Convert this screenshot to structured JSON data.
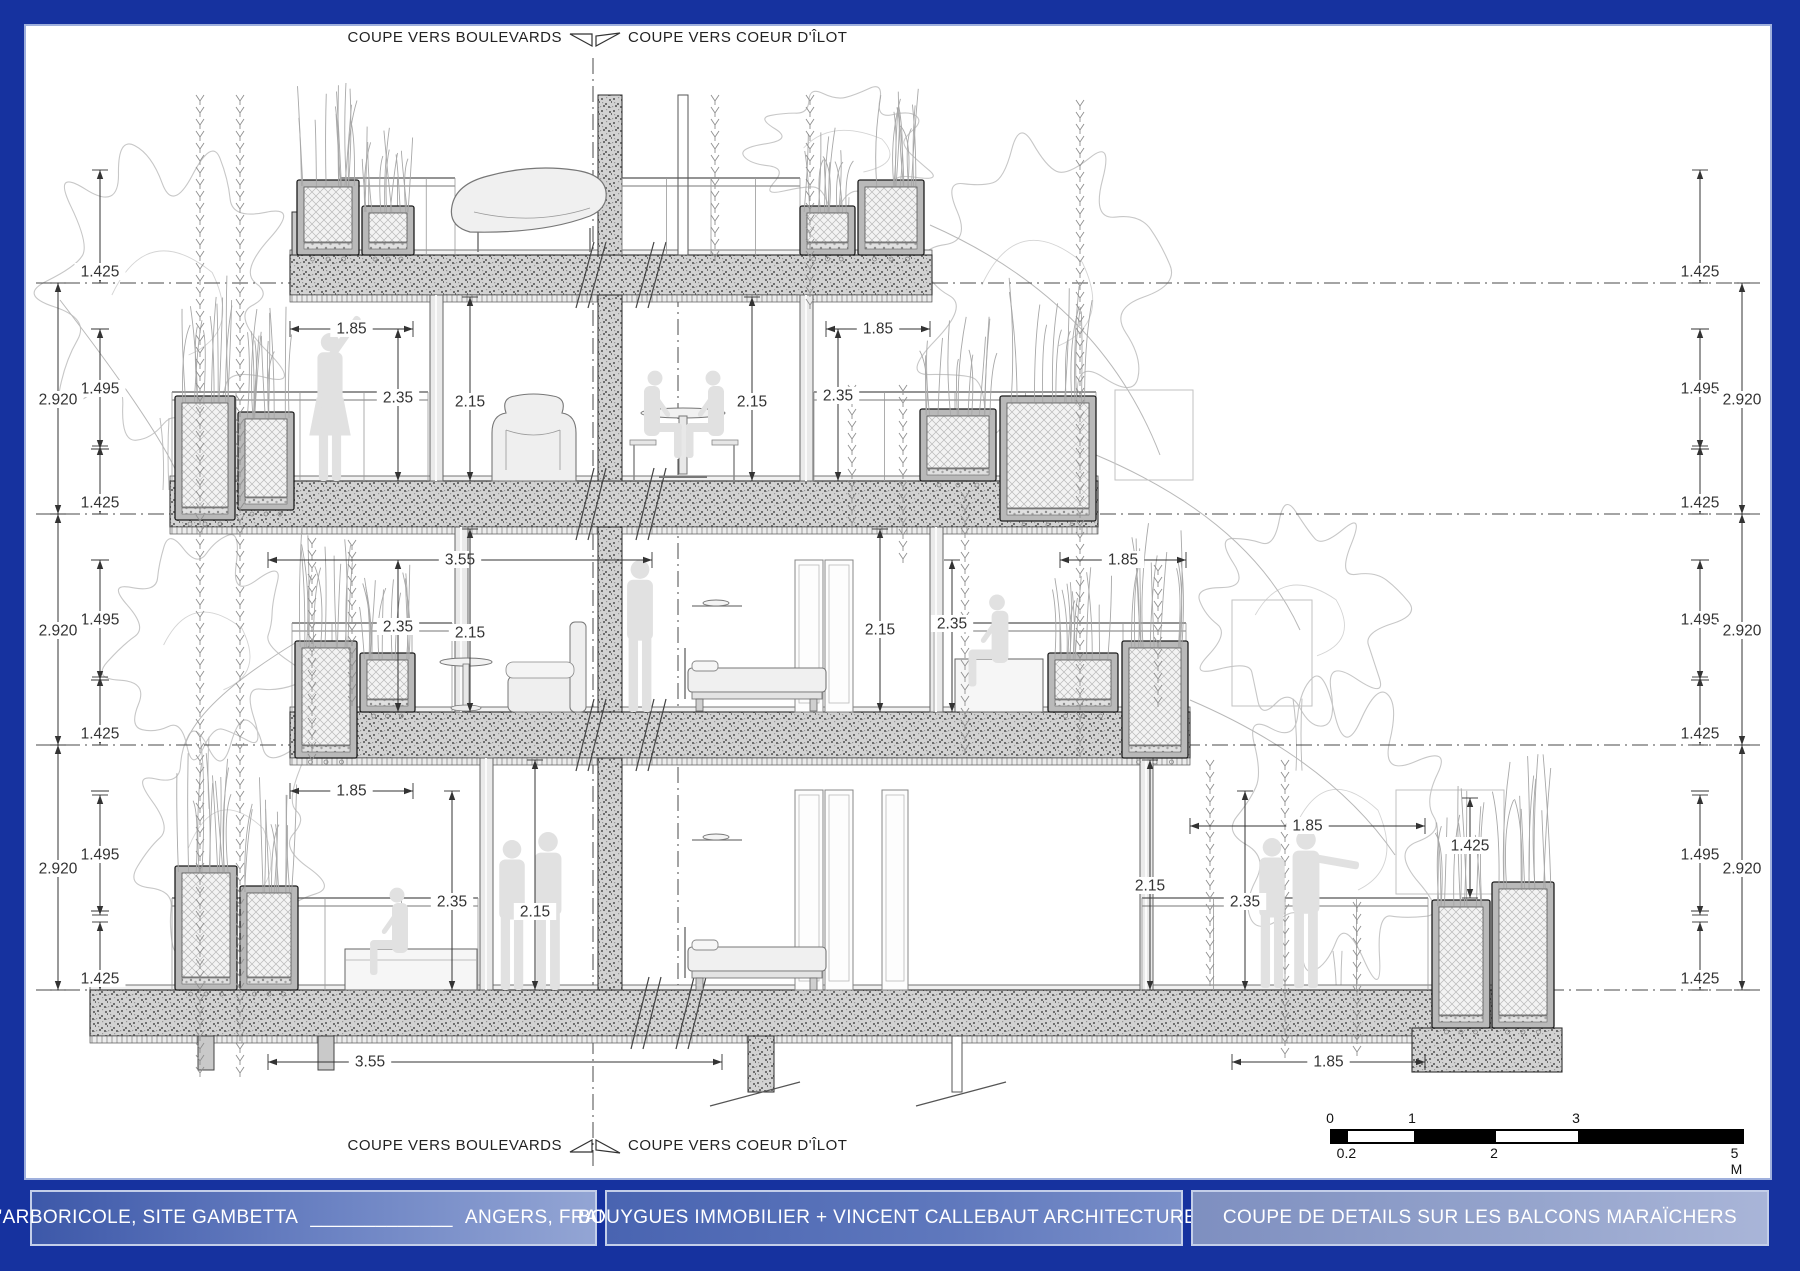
{
  "frame": {
    "border_color": "#16329f",
    "inner_line_color": "#9fb0dd",
    "paper_color": "#ffffff"
  },
  "section_markers": {
    "top_left": "COUPE VERS BOULEVARDS",
    "top_right": "COUPE VERS COEUR D'ÎLOT",
    "bottom_left": "COUPE VERS BOULEVARDS",
    "bottom_right": "COUPE VERS COEUR D'ÎLOT"
  },
  "title_bar": {
    "panel_project": {
      "name": "L'ARBORICOLE, SITE GAMBETTA",
      "separator": "_____________",
      "location": "ANGERS, FRANCE"
    },
    "panel_team": "BOUYGUES IMMOBILIER + VINCENT CALLEBAUT ARCHITECTURES",
    "panel_drawing": "COUPE DE DETAILS SUR LES BALCONS MARAÏCHERS"
  },
  "scale_bar": {
    "total_m": 5,
    "above": [
      {
        "t": "0",
        "m": 0
      },
      {
        "t": "1",
        "m": 1
      },
      {
        "t": "3",
        "m": 3
      }
    ],
    "below": [
      {
        "t": "0.2",
        "m": 0.2
      },
      {
        "t": "2",
        "m": 2
      },
      {
        "t": "5 M",
        "m": 5
      }
    ],
    "segments": [
      {
        "from": 0,
        "to": 0.2,
        "fill": "#000"
      },
      {
        "from": 0.2,
        "to": 1,
        "fill": "#fff"
      },
      {
        "from": 1,
        "to": 2,
        "fill": "#000"
      },
      {
        "from": 2,
        "to": 3,
        "fill": "#fff"
      },
      {
        "from": 3,
        "to": 5,
        "fill": "#000"
      }
    ]
  },
  "dimensions": [
    {
      "o": "v",
      "x": 100,
      "y1": 170,
      "y2": 283,
      "t": "1.425",
      "ly": 272
    },
    {
      "o": "v",
      "x": 100,
      "y1": 329,
      "y2": 449,
      "t": "1.495",
      "ly": 389
    },
    {
      "o": "v",
      "x": 58,
      "y1": 283,
      "y2": 514,
      "t": "2.920",
      "ly": 400
    },
    {
      "o": "v",
      "x": 100,
      "y1": 446,
      "y2": 514,
      "t": "1.425",
      "ly": 503
    },
    {
      "o": "v",
      "x": 100,
      "y1": 560,
      "y2": 680,
      "t": "1.495",
      "ly": 620
    },
    {
      "o": "v",
      "x": 58,
      "y1": 514,
      "y2": 745,
      "t": "2.920",
      "ly": 631
    },
    {
      "o": "v",
      "x": 100,
      "y1": 677,
      "y2": 745,
      "t": "1.425",
      "ly": 734
    },
    {
      "o": "v",
      "x": 100,
      "y1": 795,
      "y2": 915,
      "t": "1.495",
      "ly": 855
    },
    {
      "o": "v",
      "x": 58,
      "y1": 745,
      "y2": 990,
      "t": "2.920",
      "ly": 869
    },
    {
      "o": "v",
      "x": 100,
      "y1": 922,
      "y2": 990,
      "t": "1.425",
      "ly": 979
    },
    {
      "o": "v",
      "x": 1700,
      "y1": 170,
      "y2": 283,
      "t": "1.425",
      "ly": 272
    },
    {
      "o": "v",
      "x": 1700,
      "y1": 329,
      "y2": 449,
      "t": "1.495",
      "ly": 389
    },
    {
      "o": "v",
      "x": 1742,
      "y1": 283,
      "y2": 514,
      "t": "2.920",
      "ly": 400
    },
    {
      "o": "v",
      "x": 1700,
      "y1": 446,
      "y2": 514,
      "t": "1.425",
      "ly": 503
    },
    {
      "o": "v",
      "x": 1700,
      "y1": 560,
      "y2": 680,
      "t": "1.495",
      "ly": 620
    },
    {
      "o": "v",
      "x": 1742,
      "y1": 514,
      "y2": 745,
      "t": "2.920",
      "ly": 631
    },
    {
      "o": "v",
      "x": 1700,
      "y1": 677,
      "y2": 745,
      "t": "1.425",
      "ly": 734
    },
    {
      "o": "v",
      "x": 1700,
      "y1": 795,
      "y2": 915,
      "t": "1.495",
      "ly": 855
    },
    {
      "o": "v",
      "x": 1742,
      "y1": 745,
      "y2": 990,
      "t": "2.920",
      "ly": 869
    },
    {
      "o": "v",
      "x": 1700,
      "y1": 922,
      "y2": 990,
      "t": "1.425",
      "ly": 979
    },
    {
      "o": "v",
      "x": 1470,
      "y1": 798,
      "y2": 898,
      "t": "1.425",
      "ly": 846
    },
    {
      "o": "h",
      "x1": 290,
      "x2": 413,
      "y": 329,
      "t": "1.85"
    },
    {
      "o": "h",
      "x1": 826,
      "x2": 930,
      "y": 329,
      "t": "1.85"
    },
    {
      "o": "h",
      "x1": 268,
      "x2": 652,
      "y": 560,
      "t": "3.55"
    },
    {
      "o": "h",
      "x1": 1060,
      "x2": 1186,
      "y": 560,
      "t": "1.85"
    },
    {
      "o": "h",
      "x1": 290,
      "x2": 413,
      "y": 791,
      "t": "1.85"
    },
    {
      "o": "h",
      "x1": 1190,
      "x2": 1425,
      "y": 826,
      "t": "1.85"
    },
    {
      "o": "h",
      "x1": 268,
      "x2": 722,
      "y": 1062,
      "t": "3.55",
      "lx": 370
    },
    {
      "o": "h",
      "x1": 1232,
      "x2": 1425,
      "y": 1062,
      "t": "1.85"
    },
    {
      "o": "v",
      "x": 398,
      "y1": 329,
      "y2": 481,
      "t": "2.35",
      "ly": 398
    },
    {
      "o": "v",
      "x": 470,
      "y1": 297,
      "y2": 481,
      "t": "2.15",
      "ly": 402
    },
    {
      "o": "v",
      "x": 752,
      "y1": 297,
      "y2": 481,
      "t": "2.15",
      "ly": 402
    },
    {
      "o": "v",
      "x": 838,
      "y1": 329,
      "y2": 481,
      "t": "2.35",
      "ly": 396
    },
    {
      "o": "v",
      "x": 398,
      "y1": 560,
      "y2": 712,
      "t": "2.35",
      "ly": 627
    },
    {
      "o": "v",
      "x": 470,
      "y1": 529,
      "y2": 712,
      "t": "2.15",
      "ly": 633
    },
    {
      "o": "v",
      "x": 880,
      "y1": 529,
      "y2": 712,
      "t": "2.15",
      "ly": 630
    },
    {
      "o": "v",
      "x": 952,
      "y1": 560,
      "y2": 712,
      "t": "2.35",
      "ly": 624
    },
    {
      "o": "v",
      "x": 452,
      "y1": 791,
      "y2": 990,
      "t": "2.35",
      "ly": 902
    },
    {
      "o": "v",
      "x": 535,
      "y1": 760,
      "y2": 990,
      "t": "2.15",
      "ly": 912
    },
    {
      "o": "v",
      "x": 1150,
      "y1": 760,
      "y2": 990,
      "t": "2.15",
      "ly": 886
    },
    {
      "o": "v",
      "x": 1245,
      "y1": 791,
      "y2": 990,
      "t": "2.35",
      "ly": 902
    }
  ],
  "drawing_meta": {
    "line_color": "#3c3c3c",
    "dim_color": "#333333",
    "figure_color": "#e1e1e1"
  }
}
